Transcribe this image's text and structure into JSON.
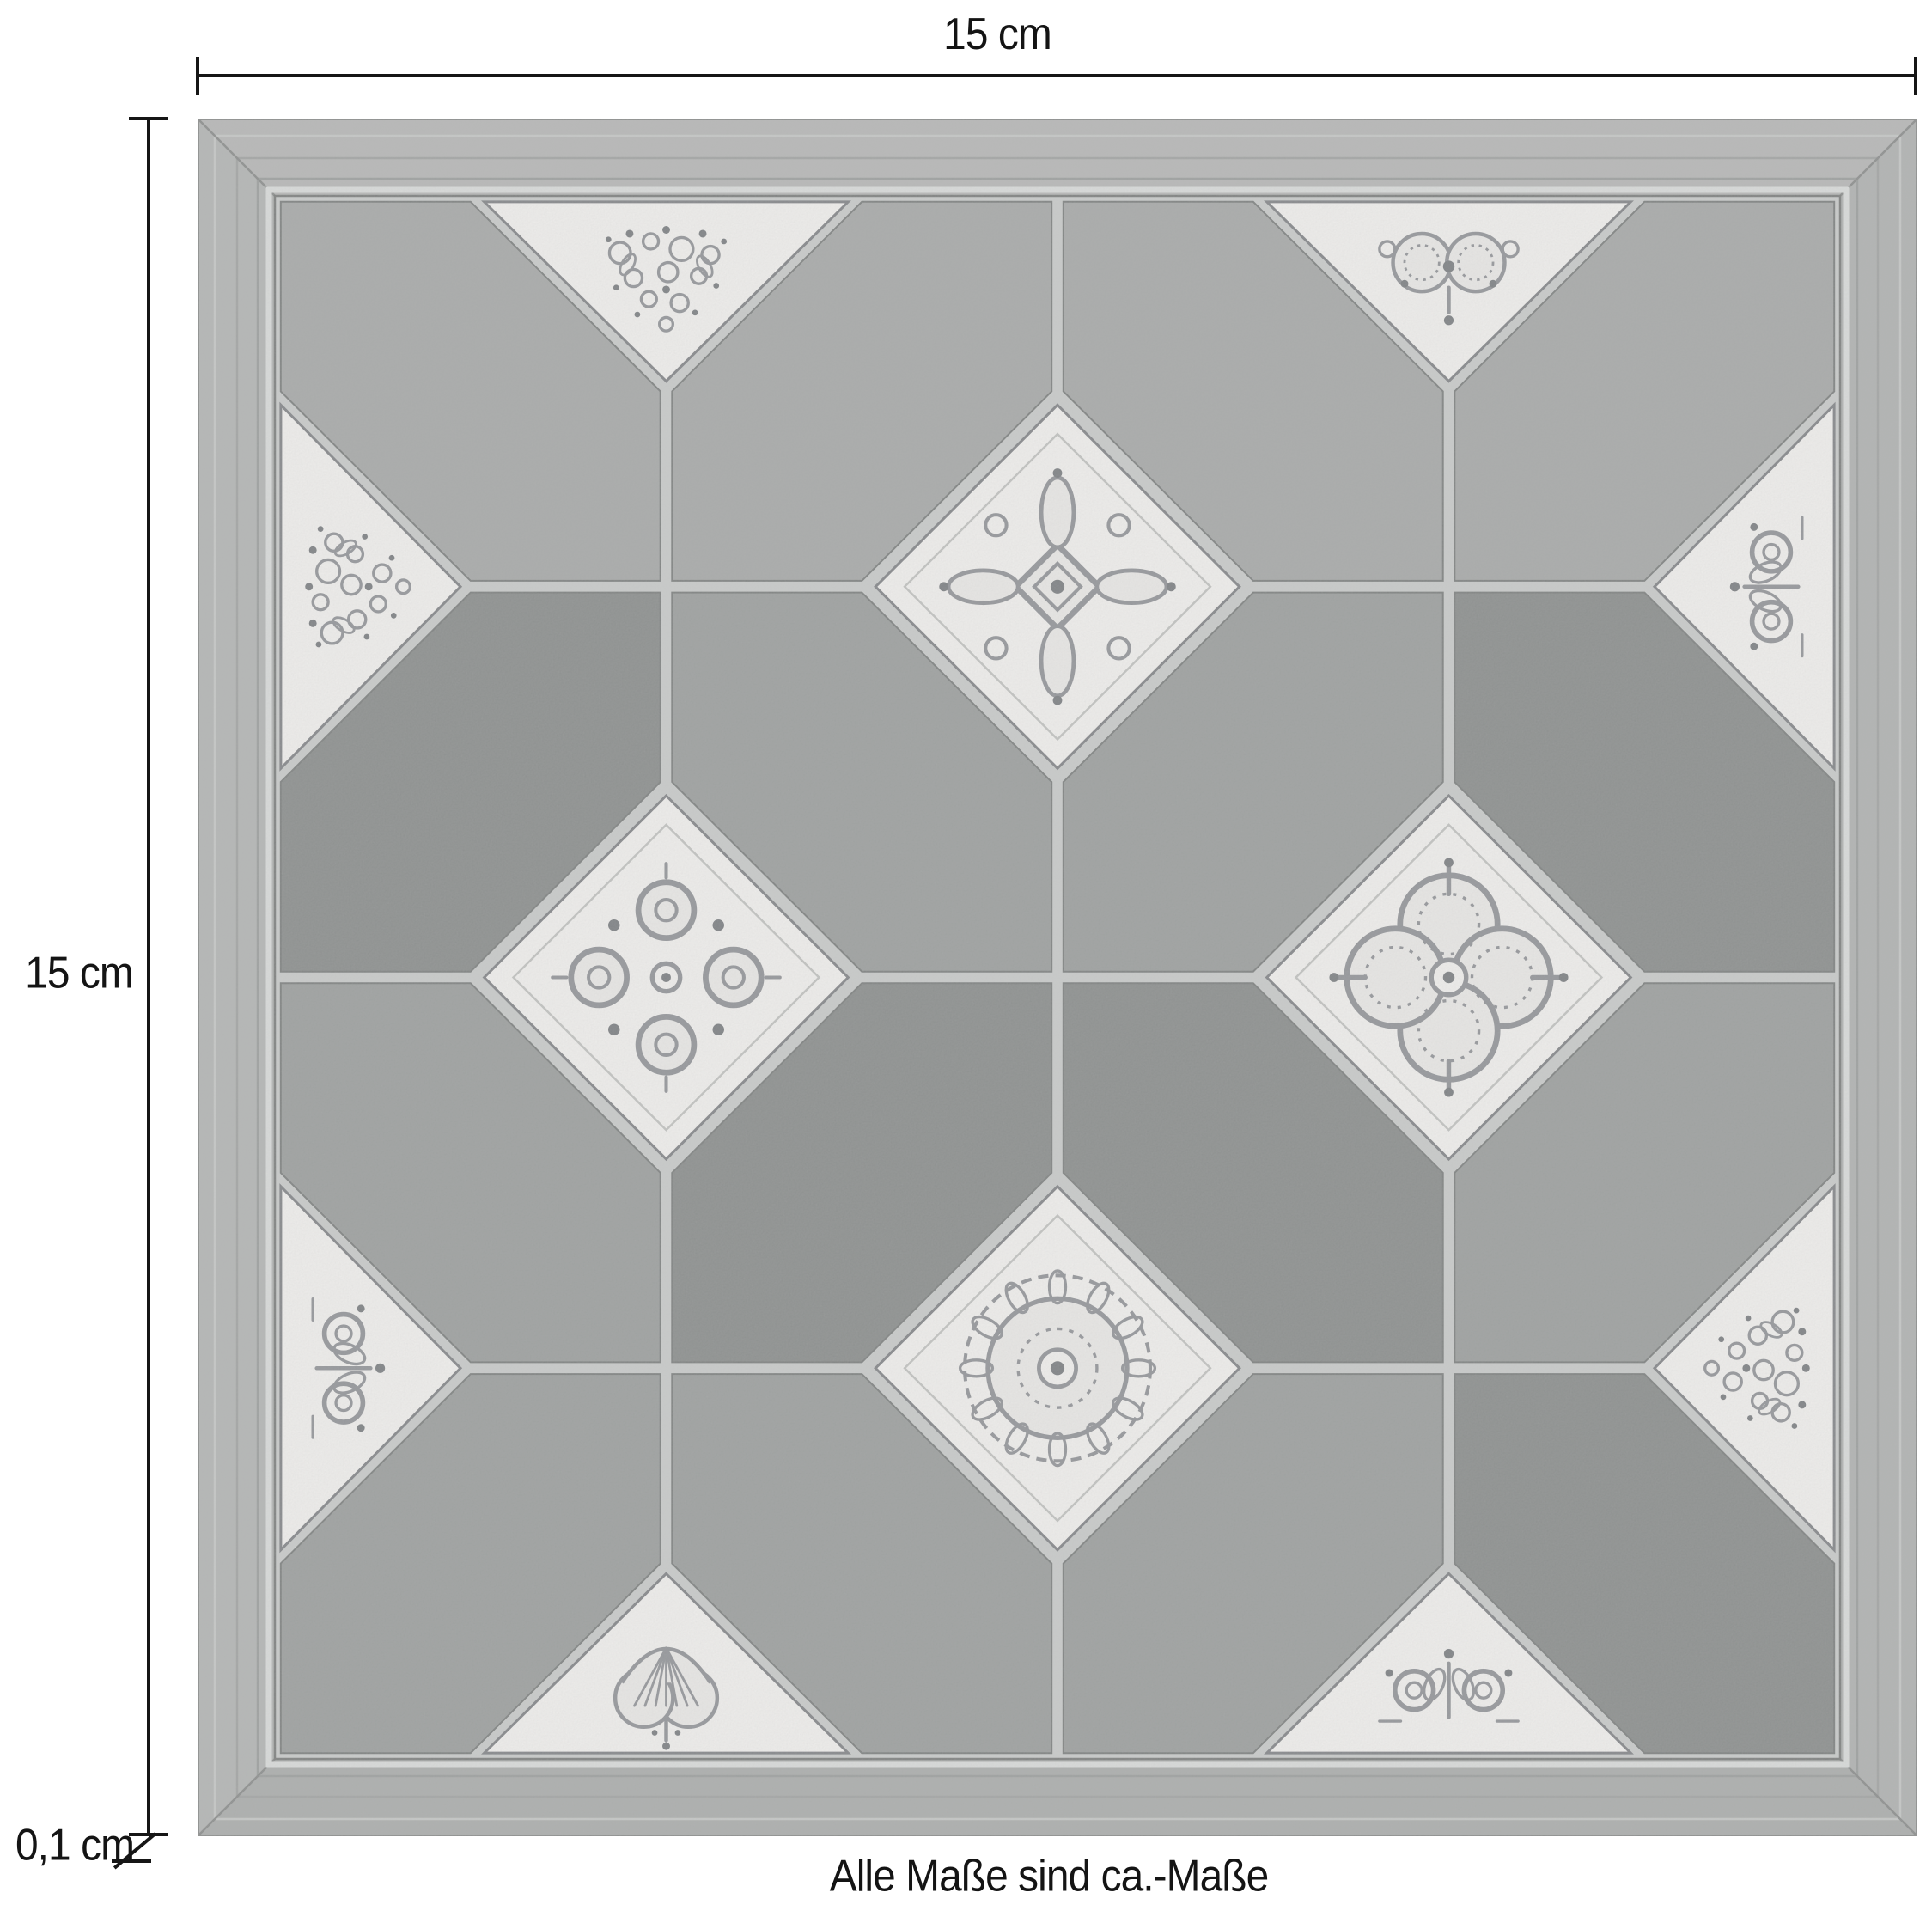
{
  "dimensions": {
    "top_width": {
      "label": "15 cm"
    },
    "left_height": {
      "label": "15 cm"
    },
    "thickness": {
      "label": "0,1 cm"
    },
    "footnote": "Alle Maße sind ca.-Maße"
  },
  "tile": {
    "colors": {
      "frame_top": "#b7b8b7",
      "frame_right": "#b1b3b2",
      "frame_bottom": "#acaead",
      "frame_left": "#b4b6b5",
      "frame_line": "#8d8f8e",
      "streak_light": "#c5c7c6",
      "streak_mid": "#a3a5a4",
      "streak_dark": "#9da09f",
      "bevel_light": "#d9dbda",
      "bevel_dark": "#7f8180",
      "grout": "#c9cbca",
      "cell_light": "#a8aaa9",
      "cell_medium": "#9da09f",
      "cell_dark": "#8c8f8e",
      "cell_edge": "#7f8281",
      "orn_bg": "#f0efed",
      "orn_bg2": "#e9e8e6",
      "orn_line": "#94969a",
      "orn_dark": "#7e8184",
      "orn_border": "#85878a",
      "orn_faint": "#c2c3c1"
    },
    "grid": 4,
    "cell_shades": [
      [
        "light",
        "light",
        "light",
        "light"
      ],
      [
        "dark",
        "medium",
        "medium",
        "dark"
      ],
      [
        "medium",
        "dark",
        "dark",
        "medium"
      ],
      [
        "medium",
        "medium",
        "medium",
        "dark"
      ]
    ],
    "ornaments": [
      {
        "node": [
          1,
          0
        ],
        "type": "damask"
      },
      {
        "node": [
          3,
          0
        ],
        "type": "rosette"
      },
      {
        "node": [
          0,
          1
        ],
        "type": "damask"
      },
      {
        "node": [
          2,
          1
        ],
        "type": "medallion"
      },
      {
        "node": [
          4,
          1
        ],
        "type": "scrolls"
      },
      {
        "node": [
          1,
          2
        ],
        "type": "scroll-medallion"
      },
      {
        "node": [
          3,
          2
        ],
        "type": "quatrefoil"
      },
      {
        "node": [
          0,
          3
        ],
        "type": "scrolls"
      },
      {
        "node": [
          4,
          3
        ],
        "type": "damask"
      },
      {
        "node": [
          2,
          3
        ],
        "type": "mandala"
      },
      {
        "node": [
          1,
          4
        ],
        "type": "palmette"
      },
      {
        "node": [
          3,
          4
        ],
        "type": "scrolls"
      }
    ]
  }
}
